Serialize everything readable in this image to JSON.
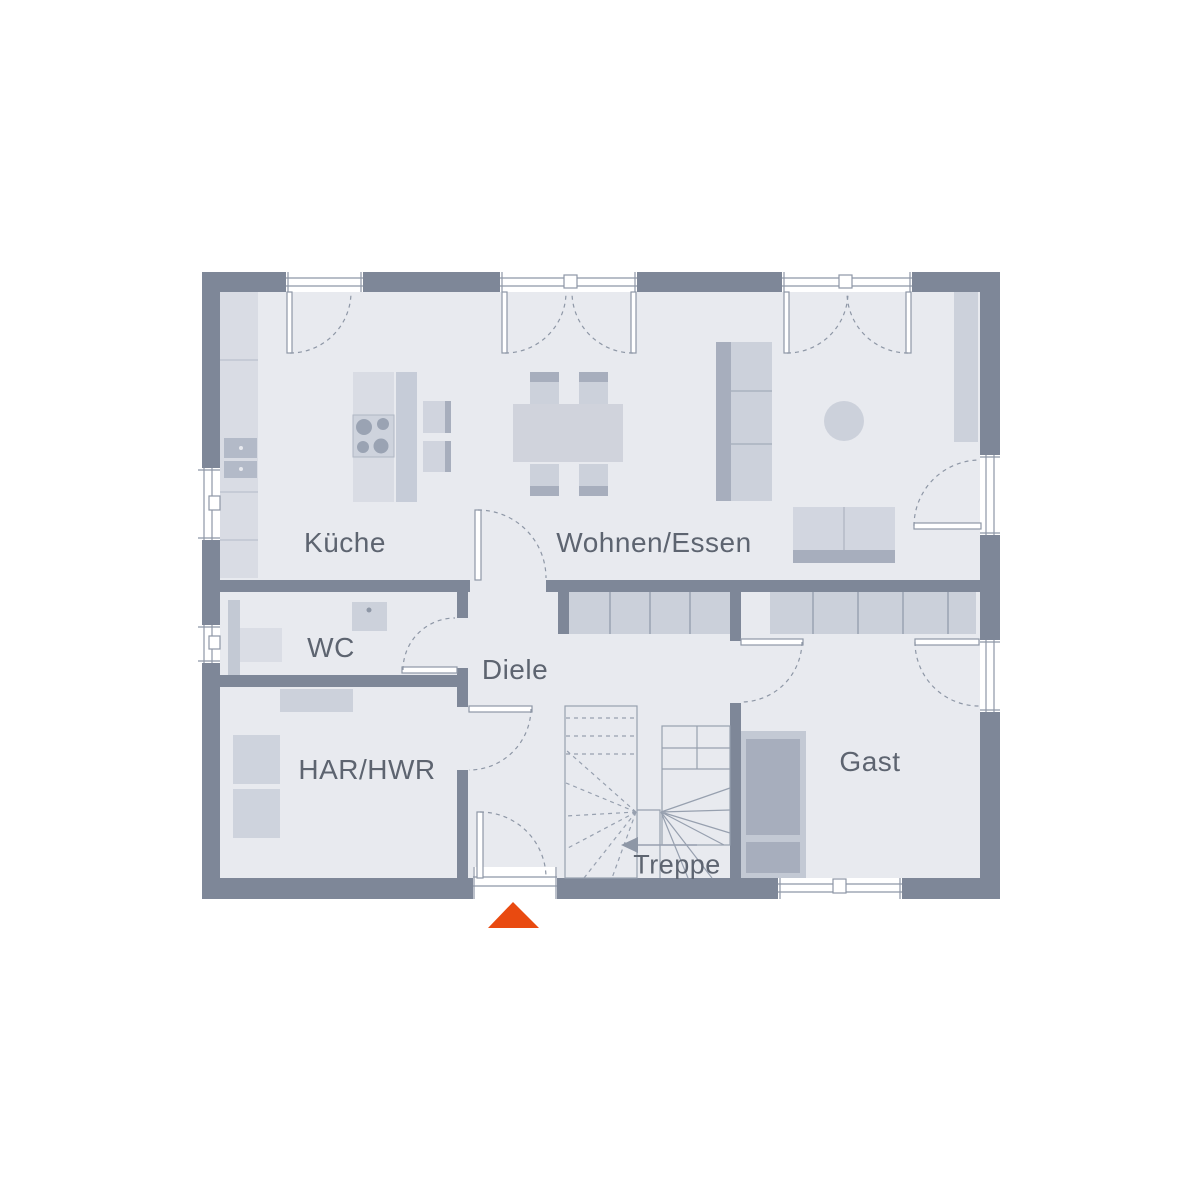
{
  "plan": {
    "type": "floor-plan",
    "rooms": {
      "kueche": {
        "label": "Küche"
      },
      "wohnen": {
        "label": "Wohnen/Essen"
      },
      "wc": {
        "label": "WC"
      },
      "diele": {
        "label": "Diele"
      },
      "har_hwr": {
        "label": "HAR/HWR"
      },
      "gast": {
        "label": "Gast"
      },
      "treppe": {
        "label": "Treppe"
      }
    },
    "entrance": {
      "marker": "entrance-triangle",
      "marker_color": "#e94a10",
      "position": "bottom-center"
    },
    "colors": {
      "wall": "#7e8798",
      "floor": "#e8eaef",
      "furniture_light": "#d9dce4",
      "furniture_mid": "#ccd1db",
      "furniture_dark": "#a7aebd",
      "line": "#8e97a6",
      "text": "#5d6470"
    }
  }
}
